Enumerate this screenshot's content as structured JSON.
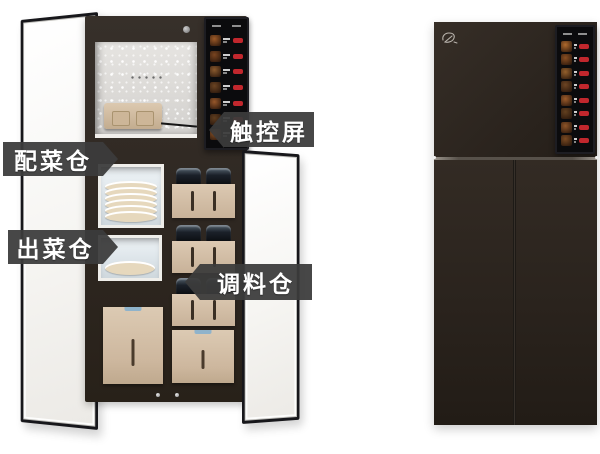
{
  "annotations": {
    "touchscreen": "触控屏",
    "ingredient_bay": "配菜仓",
    "dish_output_bay": "出菜仓",
    "seasoning_bay": "调料仓"
  },
  "screens": {
    "left": {
      "item_count": 7,
      "button_color": "#c1272d",
      "thumb_colors": [
        "#9c5a28",
        "#7a4520",
        "#8a5a2e",
        "#6b4423",
        "#97572a",
        "#5f3d1f",
        "#8c5326"
      ]
    },
    "right": {
      "item_count": 8,
      "button_color": "#c1272d",
      "thumb_colors": [
        "#b06a2d",
        "#8a4f22",
        "#94602c",
        "#6e4523",
        "#9d5c2b",
        "#63401f",
        "#8f5528",
        "#7a4a22"
      ]
    }
  },
  "colors": {
    "background": "#ffffff",
    "cabinet_dark": "#2e2721",
    "door_white": "#f8f7f4",
    "compartment_beige": "#d3bfa8",
    "handle_tab_blue": "#8fb3cb",
    "callout_bg": "#3c3c3c",
    "callout_text": "#ffffff",
    "menu_button_red": "#c1272d",
    "screen_black": "#0b0b0d"
  }
}
